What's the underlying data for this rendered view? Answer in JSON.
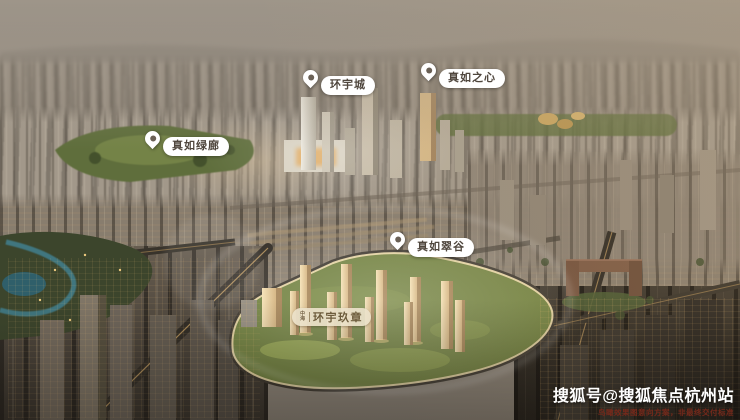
{
  "markers": [
    {
      "id": "huanyucheng",
      "label": "环宇城"
    },
    {
      "id": "zhenruzhixin",
      "label": "真如之心"
    },
    {
      "id": "zhenrulvlang",
      "label": "真如绿廊"
    },
    {
      "id": "zhenrucuigu",
      "label": "真如翠谷"
    }
  ],
  "site_plaque": {
    "logo": "中海",
    "label": "环宇玖章"
  },
  "watermark": {
    "account": "搜狐号@搜狐焦点杭州站",
    "disclaimer": "鸟瞰效果图意向方案，非最终交付标准"
  },
  "colors": {
    "pin_background": "#ffffff",
    "pin_dot": "#6a6055",
    "marker_text": "#4f463d",
    "plaque_background": "#ece2ca",
    "plaque_text": "#6d5c3c",
    "watermark_text": "#ffffff",
    "disclaimer_text": "#76291b",
    "glow_tower_gold": "#eed7a8",
    "site_green": "#71813f",
    "sky_haze": "#a89d8e"
  }
}
